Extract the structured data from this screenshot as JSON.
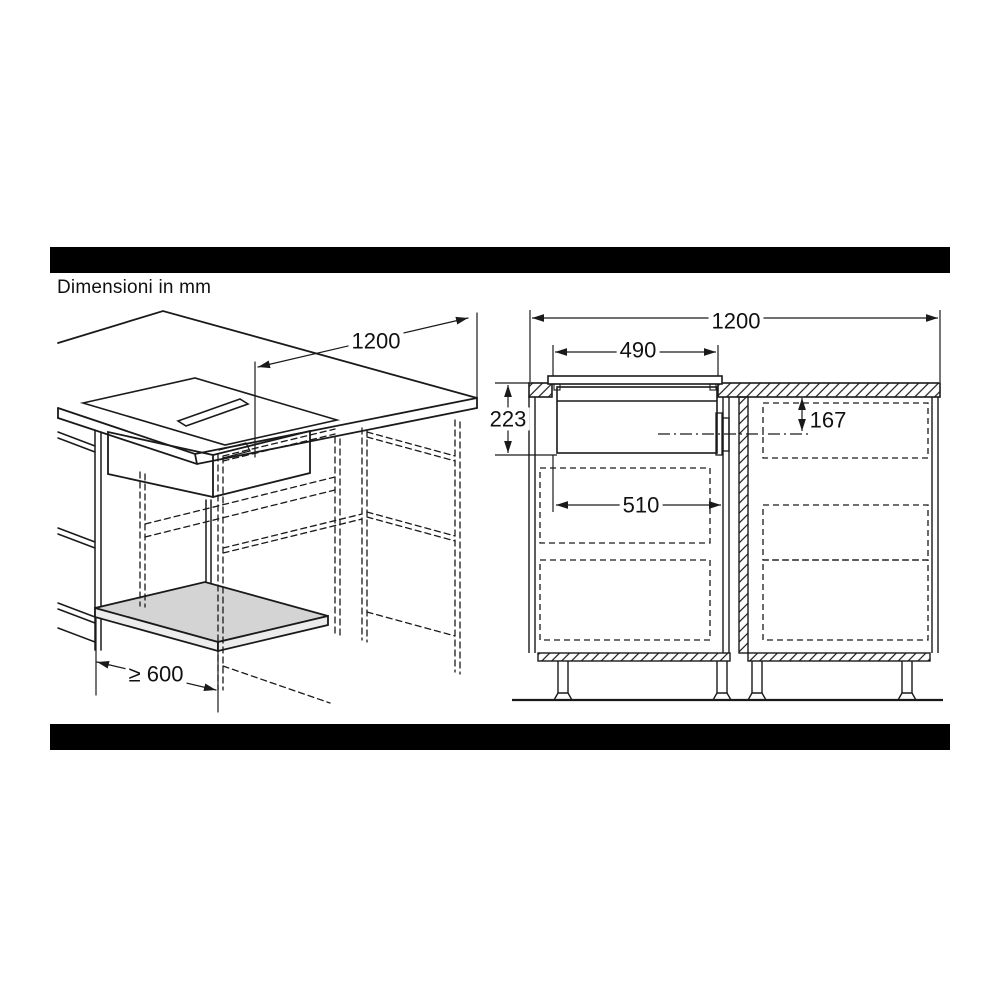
{
  "note": "Dimensioni in mm",
  "colors": {
    "line": "#1a1a1a",
    "bar": "#000000",
    "shelf_fill": "#d4d4d4",
    "background": "#ffffff"
  },
  "left_view": {
    "title": "perspective installation view",
    "dims": {
      "top_length": "1200",
      "front_clearance": "≥ 600"
    }
  },
  "right_view": {
    "title": "front section view",
    "dims": {
      "total_width": "1200",
      "hob_width": "490",
      "install_depth": "223",
      "outlet_offset": "167",
      "cutout_width": "510"
    }
  }
}
